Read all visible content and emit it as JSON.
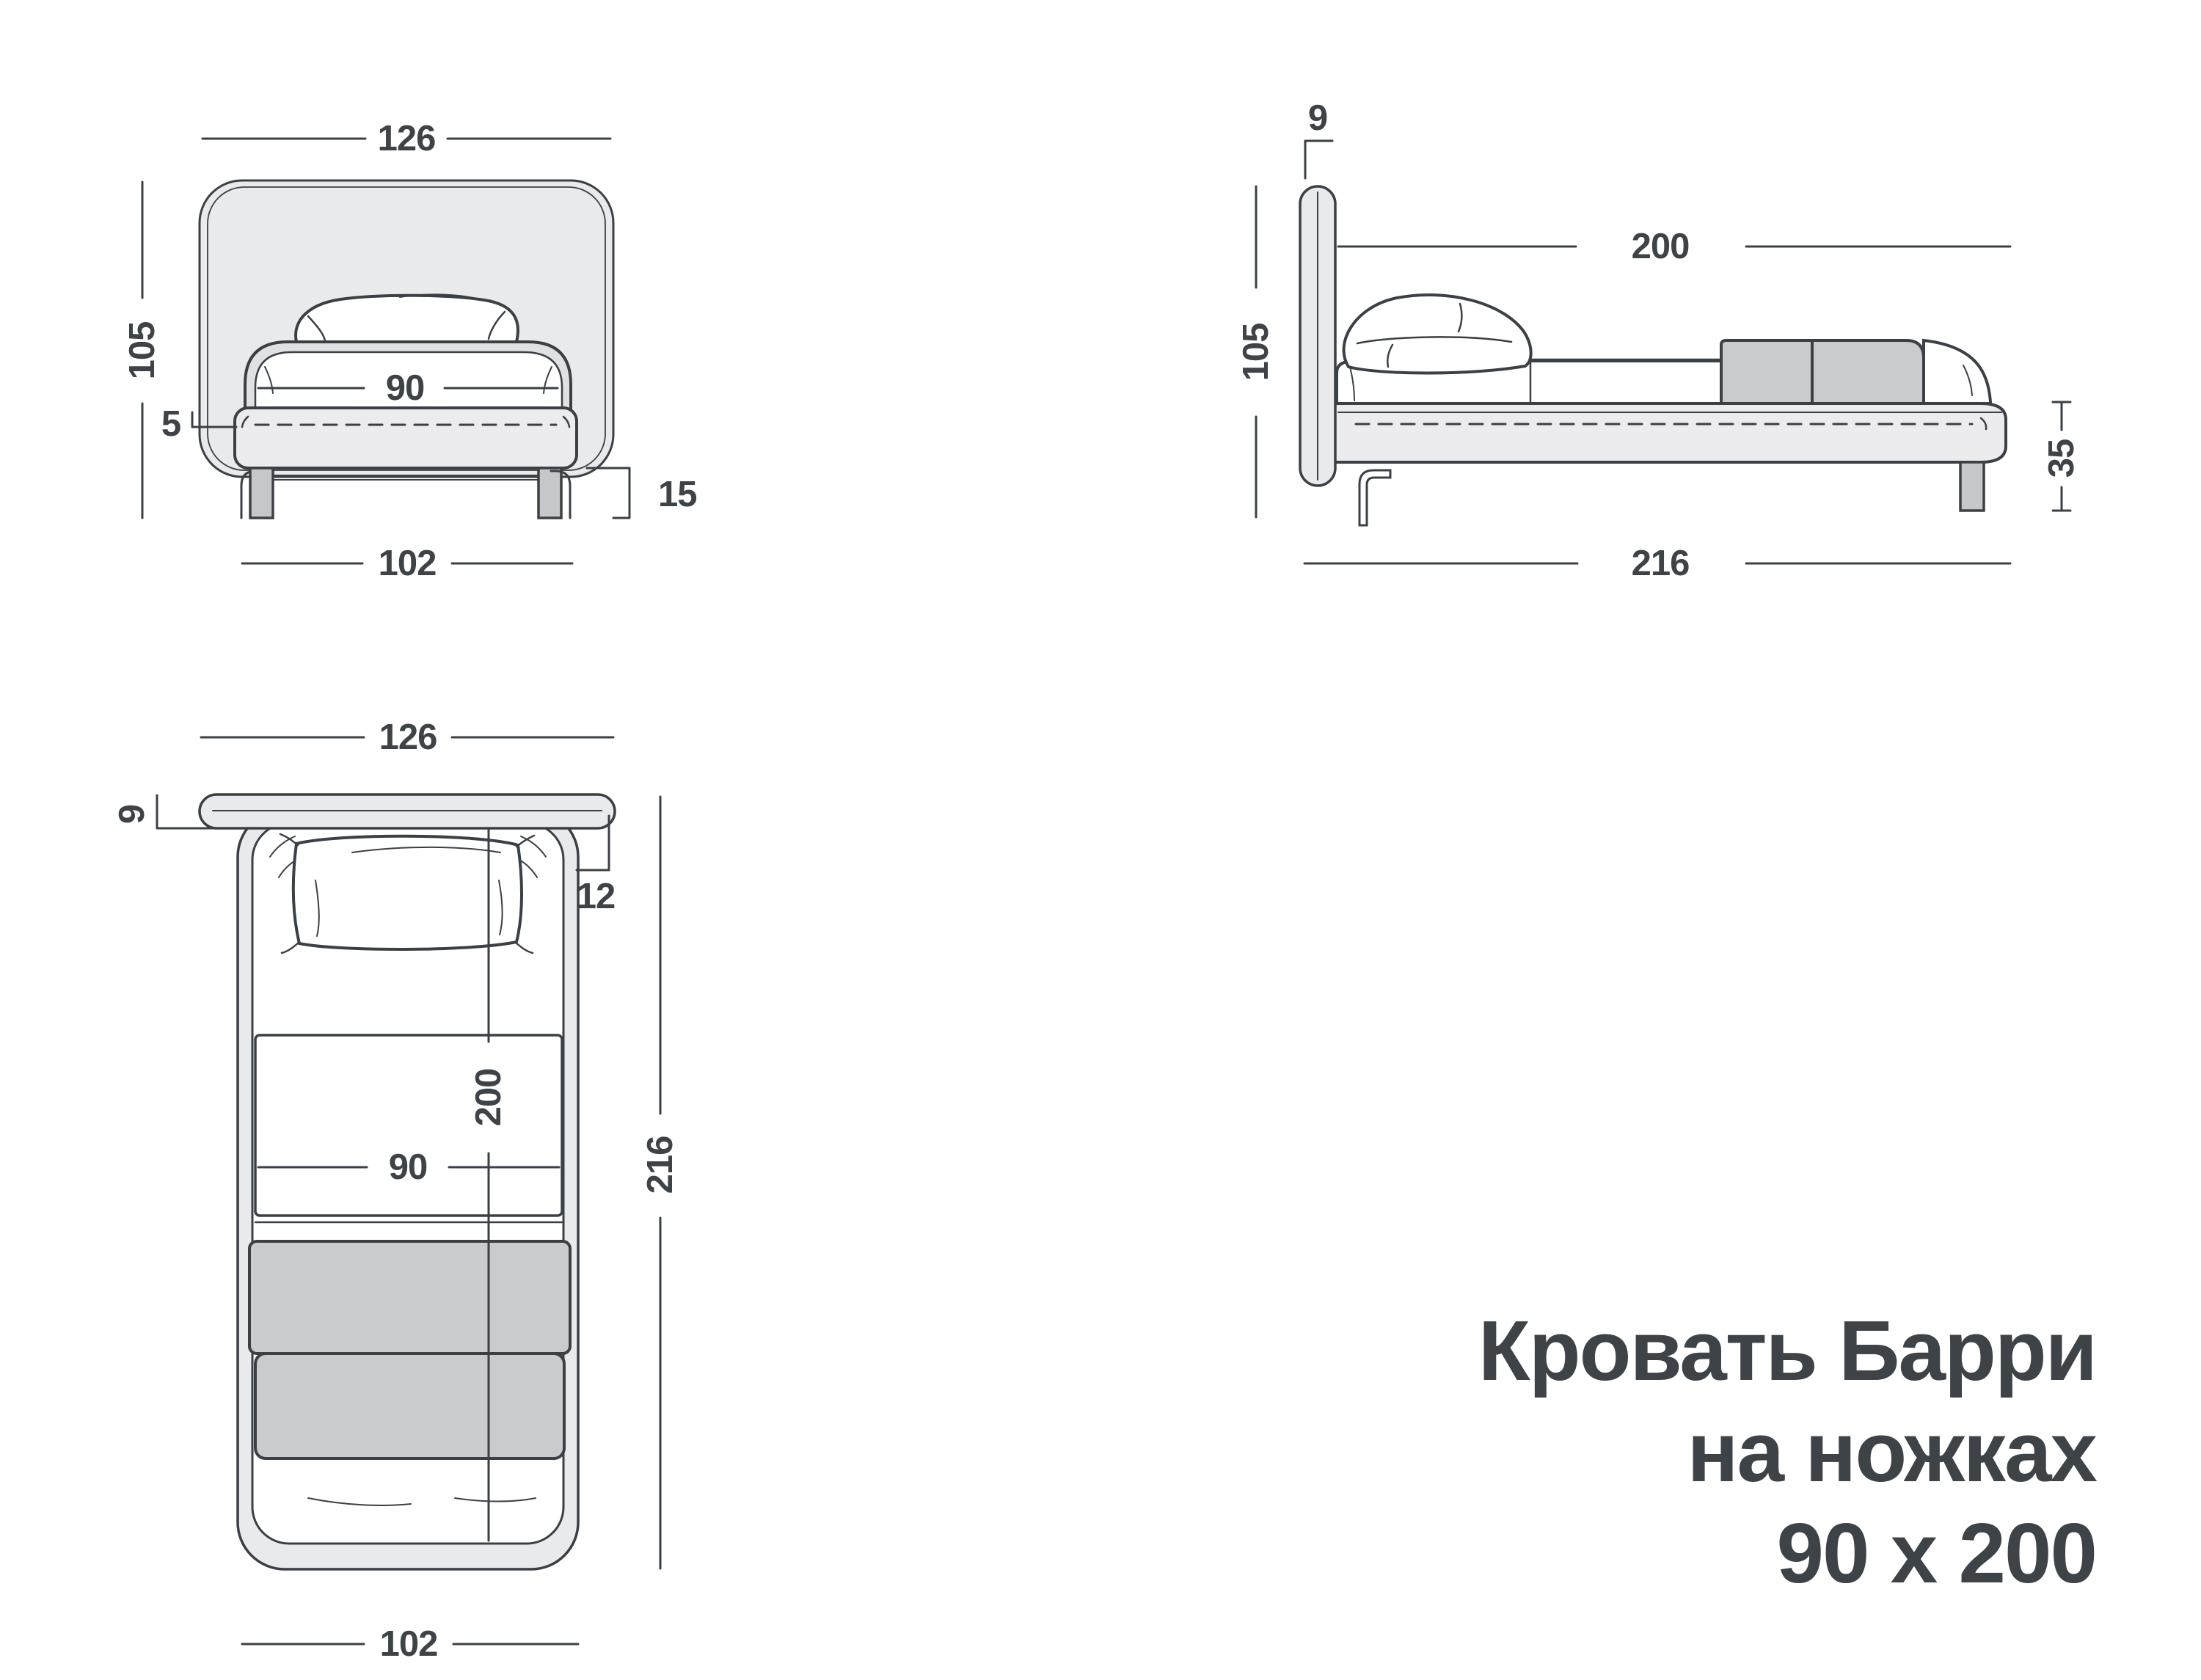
{
  "title": {
    "line1": "Кровать Барри",
    "line2": "на ножках",
    "line3": "90 х 200"
  },
  "views": {
    "front": {
      "label": "front-view",
      "dims": {
        "headboard_width": "126",
        "overall_height": "105",
        "mattress_width": "90",
        "frame_top_offset": "5",
        "leg_height": "15",
        "base_width": "102"
      }
    },
    "side": {
      "label": "side-view",
      "dims": {
        "headboard_thickness": "9",
        "sleeping_length": "200",
        "overall_height": "105",
        "base_height": "35",
        "total_length": "216"
      }
    },
    "top": {
      "label": "top-view",
      "dims": {
        "headboard_width": "126",
        "headboard_thickness": "9",
        "side_overhang": "12",
        "sleeping_length": "200",
        "sleeping_width": "90",
        "total_length": "216",
        "base_width": "102"
      }
    }
  },
  "colors": {
    "line": "#3a4045",
    "text": "#3d4347",
    "panel": "#e9eaeb",
    "panel2": "#ececee",
    "rail": "#dfe1e3",
    "gray": "#c9cbcd",
    "leg": "#c5c7c9",
    "white": "#ffffff"
  }
}
